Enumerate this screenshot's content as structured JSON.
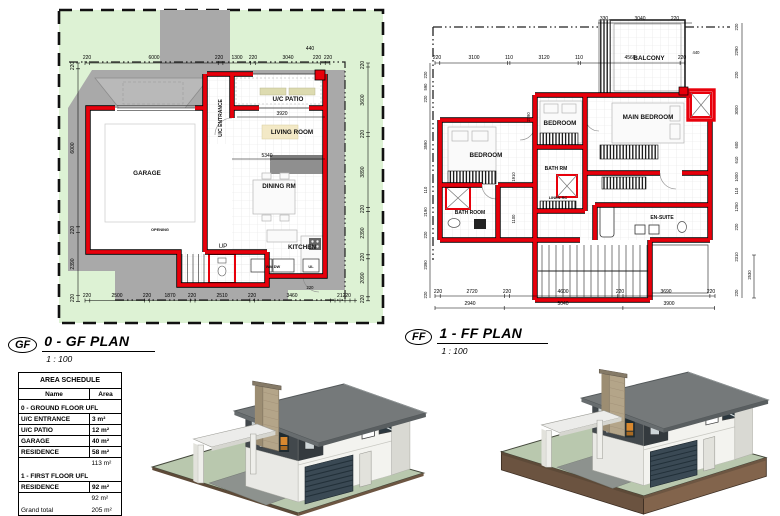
{
  "gf": {
    "badge": "GF",
    "title": "0 - GF PLAN",
    "scale": "1 : 100",
    "rooms": {
      "garage": "GARAGE",
      "entrance": "U/C ENTRANCE",
      "patio": "U/C PATIO",
      "living": "LIVING ROOM",
      "dining": "DINING RM",
      "kitchen": "KITCHEN"
    },
    "notes": {
      "up": "UP",
      "opening": "OPENING",
      "wm_dw": "WM DW",
      "ul": "UL"
    },
    "dims_top": [
      "220",
      "6000",
      "220",
      "1300",
      "220",
      "3040",
      "220",
      "220"
    ],
    "dim_top_small": "440",
    "dims_bottom": [
      "220",
      "2500",
      "220",
      "1870",
      "220",
      "2510",
      "220",
      "3460",
      "21220"
    ],
    "dims_left": [
      "220",
      "6000",
      "220",
      "2390",
      "220"
    ],
    "dims_right": [
      "220",
      "3600",
      "220",
      "3890",
      "220",
      "2390",
      "220",
      "2090",
      "220"
    ],
    "dims_inner": {
      "patio_width": "3920",
      "living_width": "5340",
      "corner": "220"
    }
  },
  "ff": {
    "badge": "FF",
    "title": "1 - FF PLAN",
    "scale": "1 : 100",
    "rooms": {
      "bedroom_left": "BEDROOM",
      "bedroom_mid": "BEDROOM",
      "main_bedroom": "MAIN BEDROOM",
      "bath_rm": "BATH RM",
      "bath_room": "BATH ROOM",
      "en_suite": "EN-SUITE",
      "linen": "LINEN RC",
      "balcony": "BALCONY"
    },
    "dims_top1": [
      "330",
      "3040",
      "220"
    ],
    "dims_top2": [
      "220",
      "3100",
      "110",
      "3120",
      "110",
      "4560",
      "220"
    ],
    "dim_top_small": "440",
    "dims_bottom1": [
      "220",
      "2720",
      "220",
      "4600",
      "220",
      "3690",
      "220"
    ],
    "dims_bottom2": [
      "2940",
      "5040",
      "3900"
    ],
    "dims_left": [
      "220",
      "590",
      "220",
      "3590",
      "110",
      "2190",
      "220",
      "2390",
      "220"
    ],
    "dims_right": [
      "220",
      "2290",
      "220",
      "3000",
      "600",
      "610",
      "1000",
      "110",
      "1250",
      "220",
      "2310",
      "220"
    ],
    "dim_right_inner": "2530",
    "dims_inner": {
      "a": "2790",
      "b": "1910",
      "c": "1100"
    }
  },
  "schedule": {
    "title": "AREA SCHEDULE",
    "col_name": "Name",
    "col_area": "Area",
    "rows": [
      {
        "name": "0 - GROUND FLOOR UFL",
        "area": ""
      },
      {
        "name": "U/C ENTRANCE",
        "area": "3 m²"
      },
      {
        "name": "U/C PATIO",
        "area": "12 m²"
      },
      {
        "name": "GARAGE",
        "area": "40 m²"
      },
      {
        "name": "RESIDENCE",
        "area": "58 m²"
      },
      {
        "name": "",
        "area": "113 m²"
      },
      {
        "name": "1 - FIRST FLOOR UFL",
        "area": ""
      },
      {
        "name": "RESIDENCE",
        "area": "92 m²"
      },
      {
        "name": "",
        "area": "92 m²"
      },
      {
        "name": "Grand total",
        "area": "205 m²"
      }
    ]
  },
  "colors": {
    "site_green": "#ddf2d4",
    "pad_gray": "#a9a9a9",
    "wall_red": "#e8000b",
    "roof_gray": "#75797a",
    "accent_charcoal": "#42484c",
    "chimney_tan": "#b4a589",
    "lawn_green": "#b9c8ae",
    "earth_brown": "#6b5340"
  }
}
